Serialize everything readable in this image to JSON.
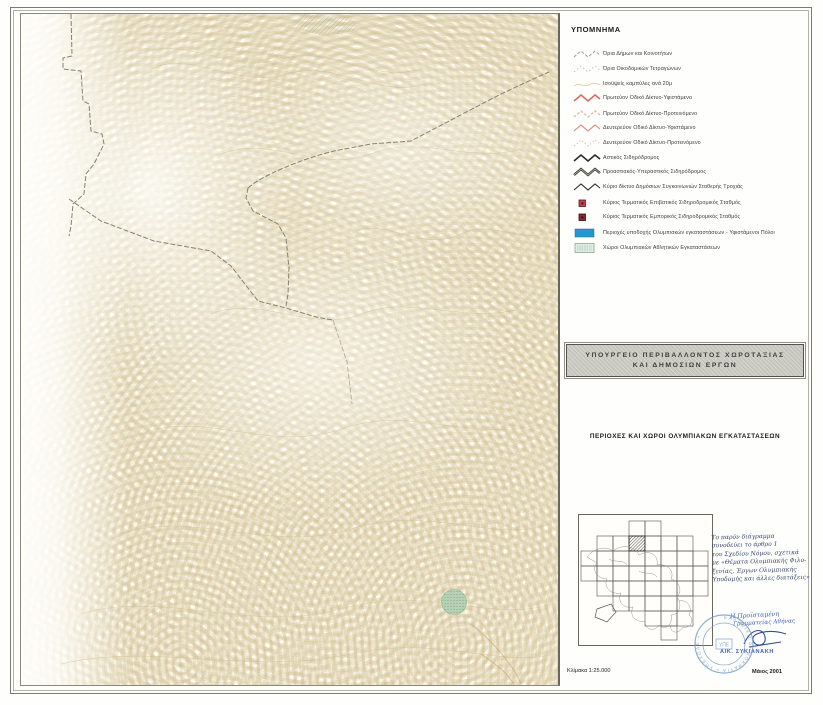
{
  "document": {
    "legend": {
      "title": "ΥΠΟΜΝΗΜΑ",
      "items": [
        {
          "label": "Όρια Δήμων και Κοινοτήτων",
          "symbol": "boundary-municipal"
        },
        {
          "label": "Όρια Οικοδομικών Τετραγώνων",
          "symbol": "boundary-blocks"
        },
        {
          "label": "Ισοϋψείς καμπύλες ανά 20μ",
          "symbol": "contour"
        },
        {
          "label": "Πρωτεύον Οδικό Δίκτυο-Υφιστάμενο",
          "symbol": "road-primary-existing"
        },
        {
          "label": "Πρωτεύον Οδικό Δίκτυο-Προτεινόμενο",
          "symbol": "road-primary-proposed"
        },
        {
          "label": "Δευτερεύον Οδικό Δίκτυο-Υφιστάμενο",
          "symbol": "road-secondary-existing"
        },
        {
          "label": "Δευτερεύον Οδικό Δίκτυο-Προτεινόμενο",
          "symbol": "road-secondary-proposed"
        },
        {
          "label": "Αστικός Σιδηρόδρομος",
          "symbol": "rail-urban"
        },
        {
          "label": "Προαστιακός-Υπεραστικός Σιδηρόδρομος",
          "symbol": "rail-suburban"
        },
        {
          "label": "Κύριο δίκτυο Δημόσιων Συγκοινωνιών Σταθερής Τροχιάς",
          "symbol": "rail-fixed-track"
        },
        {
          "label": "Κύριος Τερματικός Επιβατικός Σιδηροδρομικός Σταθμός",
          "symbol": "station-passenger"
        },
        {
          "label": "Κύριος Τερματικός Εμπορικός Σιδηροδρομικός Σταθμός",
          "symbol": "station-freight"
        },
        {
          "label": "Περιοχές υποδοχής Ολυμπιακών εγκαταστάσεων - Υφιστάμενοι Πόλοι",
          "symbol": "area-reception"
        },
        {
          "label": "Χώροι Ολυμπιακών Αθλητικών Εγκαταστάσεων",
          "symbol": "area-olympic-sites"
        }
      ]
    },
    "title_block": {
      "ministry_line1": "ΥΠΟΥΡΓΕΙΟ ΠΕΡΙΒΑΛΛΟΝΤΟΣ ΧΩΡΟΤΑΞΙΑΣ",
      "ministry_line2": "ΚΑΙ ΔΗΜΟΣΙΩΝ ΕΡΓΩΝ"
    },
    "map_title": "ΠΕΡΙΟΧΕΣ ΚΑΙ ΧΩΡΟΙ ΟΛΥΜΠΙΑΚΩΝ ΕΓΚΑΤΑΣΤΑΣΕΩΝ",
    "note": {
      "lines": [
        "Το παρόν διάγραμμα",
        "συνοδεύει το άρθρο 1",
        "του Σχεδίου Νόμου, σχετικά",
        "με «Θέματα Ολυμπιακής Φιλο-",
        "ξενίας, Έργων Ολυμπιακής",
        "Υποδομής και άλλες διατάξεις»"
      ]
    },
    "signature": {
      "title_line1": "Η Προϊσταμένη",
      "title_line2": "Γραμματείας Αθήνας",
      "name": "ΑΙΚ. ΣΥΚΙΑΝΑΚΗ"
    },
    "stamp": {
      "ring_text": "ΕΛΛΗΝΙΚΗ ΔΗΜΟΚΡΑΤΙΑ • ΥΠΕΧΩΔΕ •",
      "center_text": "ΥΠΕ"
    },
    "footer": {
      "scale": "Κλίμακα 1:25.000",
      "date": "Μάιος 2001"
    },
    "colors": {
      "road_primary_existing": "#e0685a",
      "road_primary_proposed": "#efa9a4",
      "road_secondary_existing": "#e4887a",
      "road_secondary_proposed": "#eeb5b2",
      "rail_black": "#2b2b24",
      "boundary_gray": "#9a9a96",
      "station_passenger": "#c4404c",
      "station_freight": "#8a2a34",
      "olympic_reception_cyan": "#2596cf",
      "olympic_sites_green": "#e2efe5",
      "contour_tan": "#d2be8c",
      "stamp_blue": "#6f97c6",
      "ink_blue": "#3f63ae"
    }
  }
}
